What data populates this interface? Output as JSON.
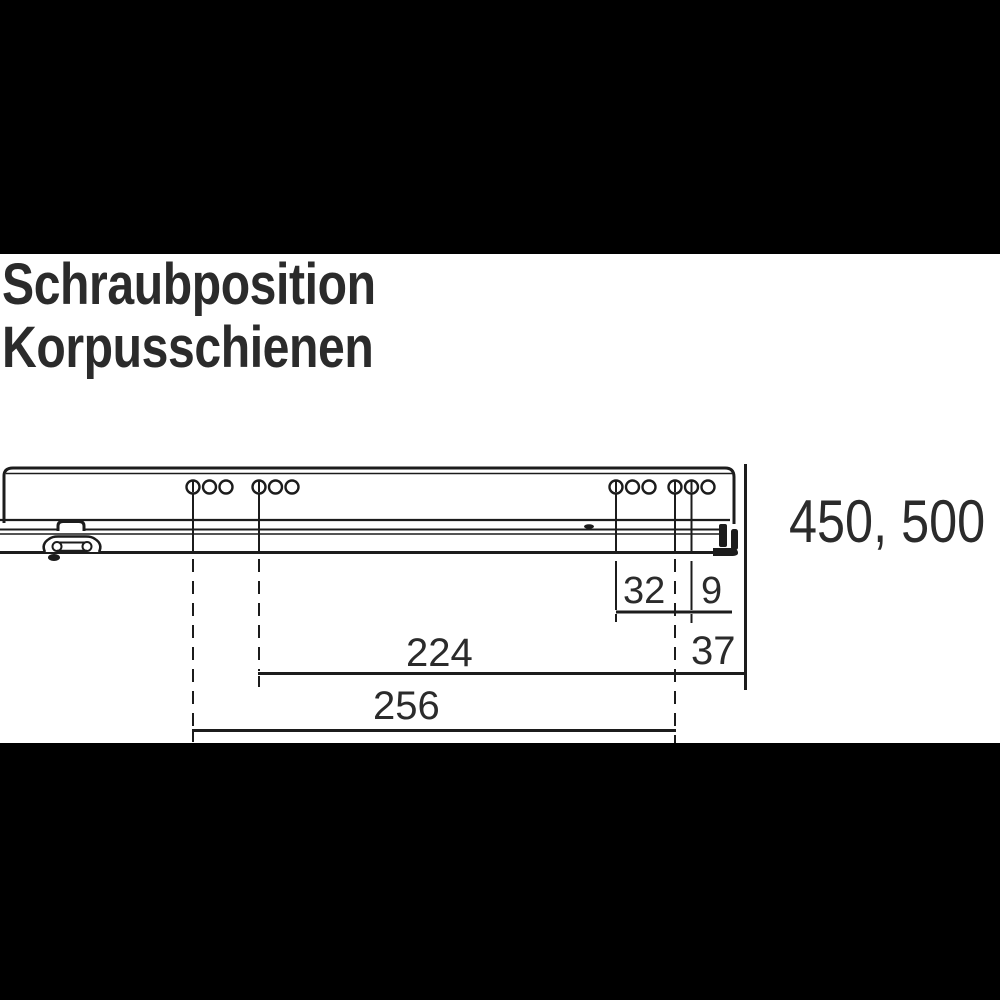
{
  "title": {
    "line1": "Schraubposition",
    "line2": "Korpusschienen"
  },
  "dimensions": {
    "group_spacing_32": "32",
    "hole_offset_9": "9",
    "front_offset_37": "37",
    "rear_group_224": "224",
    "rear_group_256": "256"
  },
  "rail_lengths_label": "450, 500",
  "colors": {
    "frame_background": "#000000",
    "panel_background": "#ffffff",
    "drawing_line": "#1c1c1c",
    "text": "#2b2b2b"
  }
}
